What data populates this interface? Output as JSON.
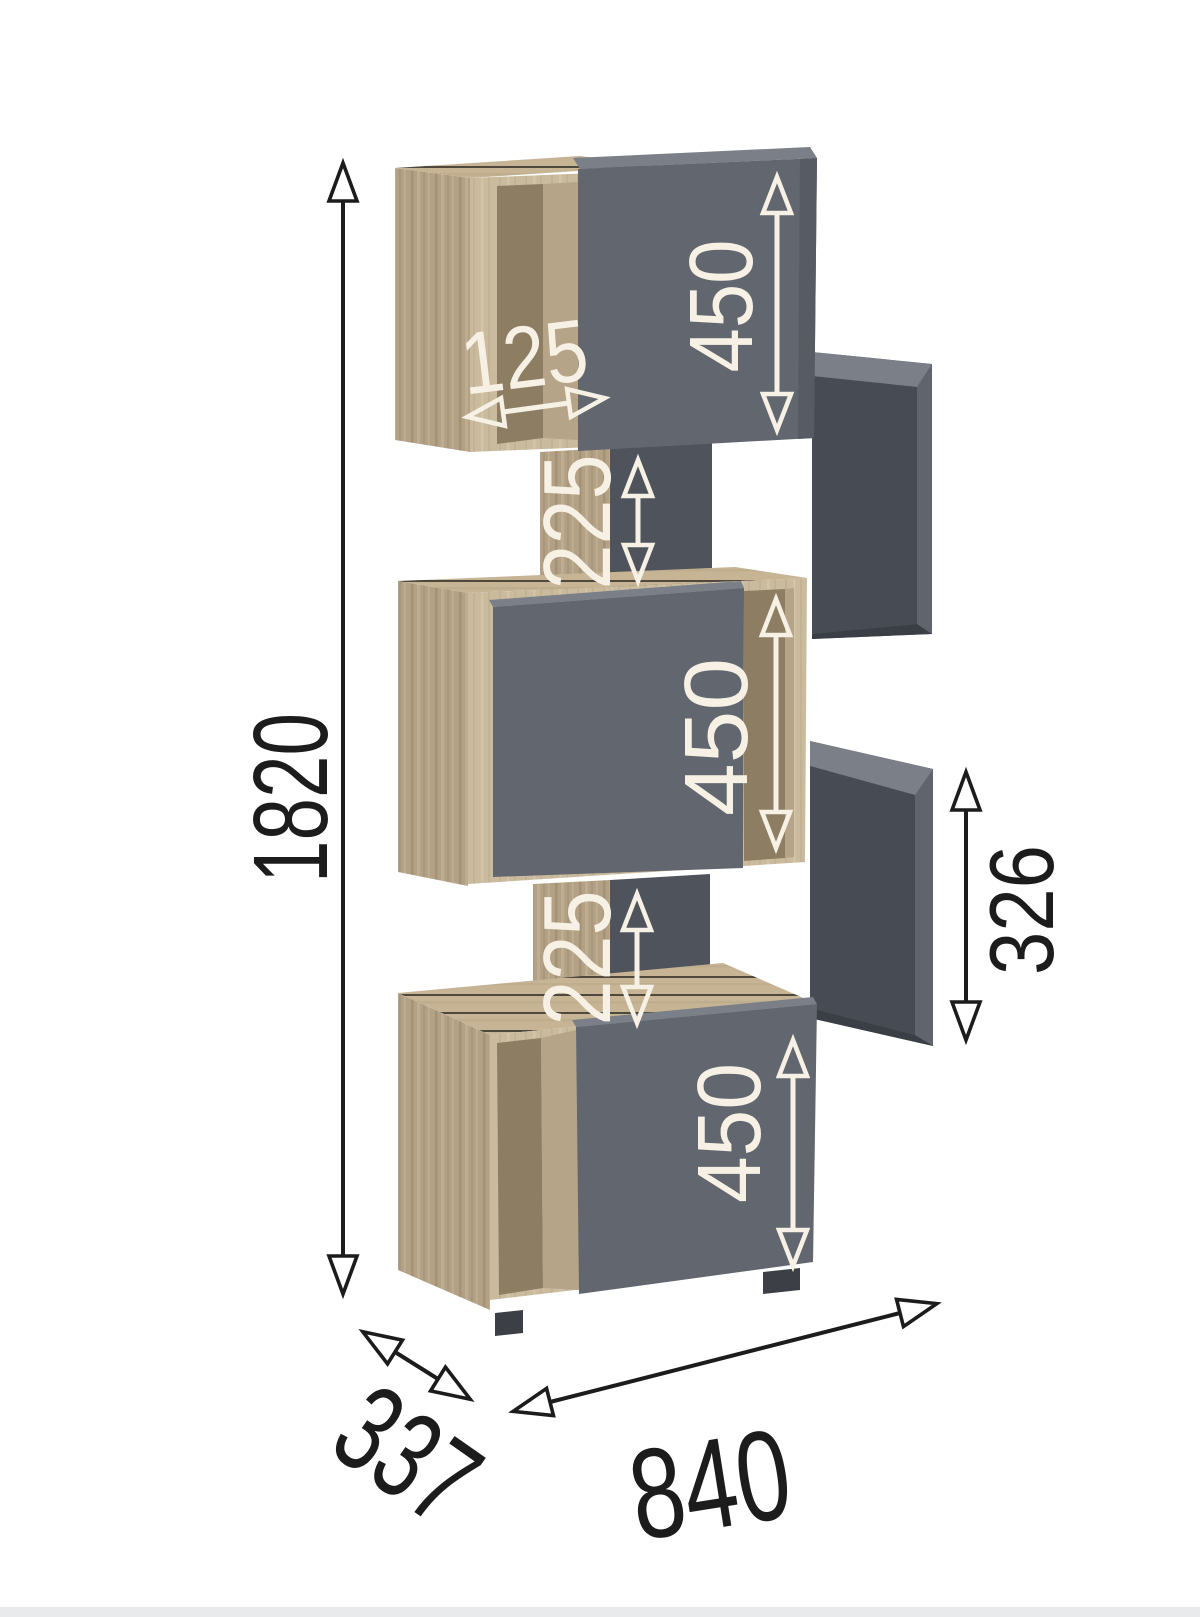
{
  "diagram": {
    "type": "furniture-dimension-diagram",
    "product": "staggered-cube-shelving-unit",
    "dimensions": {
      "overall_height_mm": "1820",
      "overall_width_mm": "840",
      "overall_depth_mm": "337",
      "top_cube_height_mm": "450",
      "middle_cube_height_mm": "450",
      "bottom_cube_height_mm": "450",
      "upper_gap_mm": "225",
      "lower_gap_mm": "225",
      "niche_depth_mm": "125",
      "side_cube_opening_mm": "326"
    },
    "colors": {
      "background": "#ffffff",
      "footer_strip": "#e9eaeb",
      "wood_side": "#b3a186",
      "wood_front": "#cbbb9e",
      "wood_top": "#c6b495",
      "wood_interior": "#8d7d63",
      "gray_door": "#61666f",
      "gray_interior": "#474c54",
      "gray_top": "#7a7f88",
      "annotation_white": "#f6f1e4",
      "annotation_black": "#1c1c1c"
    }
  }
}
